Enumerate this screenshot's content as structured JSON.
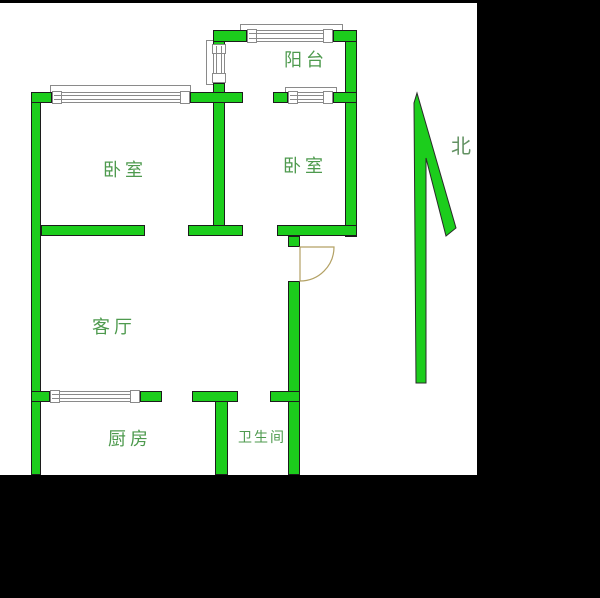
{
  "labels": {
    "balcony": "阳台",
    "bedroom_left": "卧室",
    "bedroom_right": "卧室",
    "living_room": "客厅",
    "kitchen": "厨房",
    "bathroom": "卫生间",
    "north": "北"
  },
  "icons": {
    "north_arrow": "north-arrow",
    "entry_door": "entry-door-swing"
  },
  "colors": {
    "wall_green": "#1ccd1c",
    "wall_outline": "#1c1c1c",
    "window_line": "#8a8a8a",
    "label_green": "#4e9a4e",
    "door_tan": "#b3a164",
    "frame_black": "#000000",
    "bg": "#ffffff"
  },
  "plan": {
    "walls": [
      [
        31,
        92,
        10,
        383
      ],
      [
        213,
        92,
        12,
        144
      ],
      [
        213,
        30,
        12,
        15
      ],
      [
        213,
        83,
        12,
        20
      ],
      [
        345,
        30,
        12,
        207
      ],
      [
        215,
        391,
        13,
        84
      ],
      [
        288,
        281,
        12,
        194
      ],
      [
        288,
        236,
        12,
        11
      ],
      [
        31,
        92,
        21,
        11
      ],
      [
        190,
        92,
        53,
        11
      ],
      [
        273,
        92,
        15,
        11
      ],
      [
        333,
        92,
        24,
        11
      ],
      [
        213,
        30,
        34,
        12
      ],
      [
        333,
        30,
        24,
        12
      ],
      [
        41,
        225,
        104,
        11
      ],
      [
        188,
        225,
        55,
        11
      ],
      [
        277,
        225,
        80,
        11
      ],
      [
        31,
        391,
        19,
        11
      ],
      [
        140,
        391,
        22,
        11
      ],
      [
        192,
        391,
        46,
        11
      ],
      [
        270,
        391,
        30,
        11
      ]
    ],
    "windows_h": [
      [
        52,
        92,
        138,
        11
      ],
      [
        288,
        92,
        45,
        11
      ],
      [
        247,
        30,
        86,
        12
      ],
      [
        50,
        391,
        90,
        11
      ]
    ],
    "windows_v": [
      [
        213,
        44,
        12,
        39
      ]
    ],
    "sills": [
      [
        50,
        85,
        141,
        8
      ],
      [
        240,
        24,
        103,
        7
      ],
      [
        285,
        87,
        52,
        6
      ],
      [
        206,
        40,
        8,
        45
      ]
    ]
  }
}
